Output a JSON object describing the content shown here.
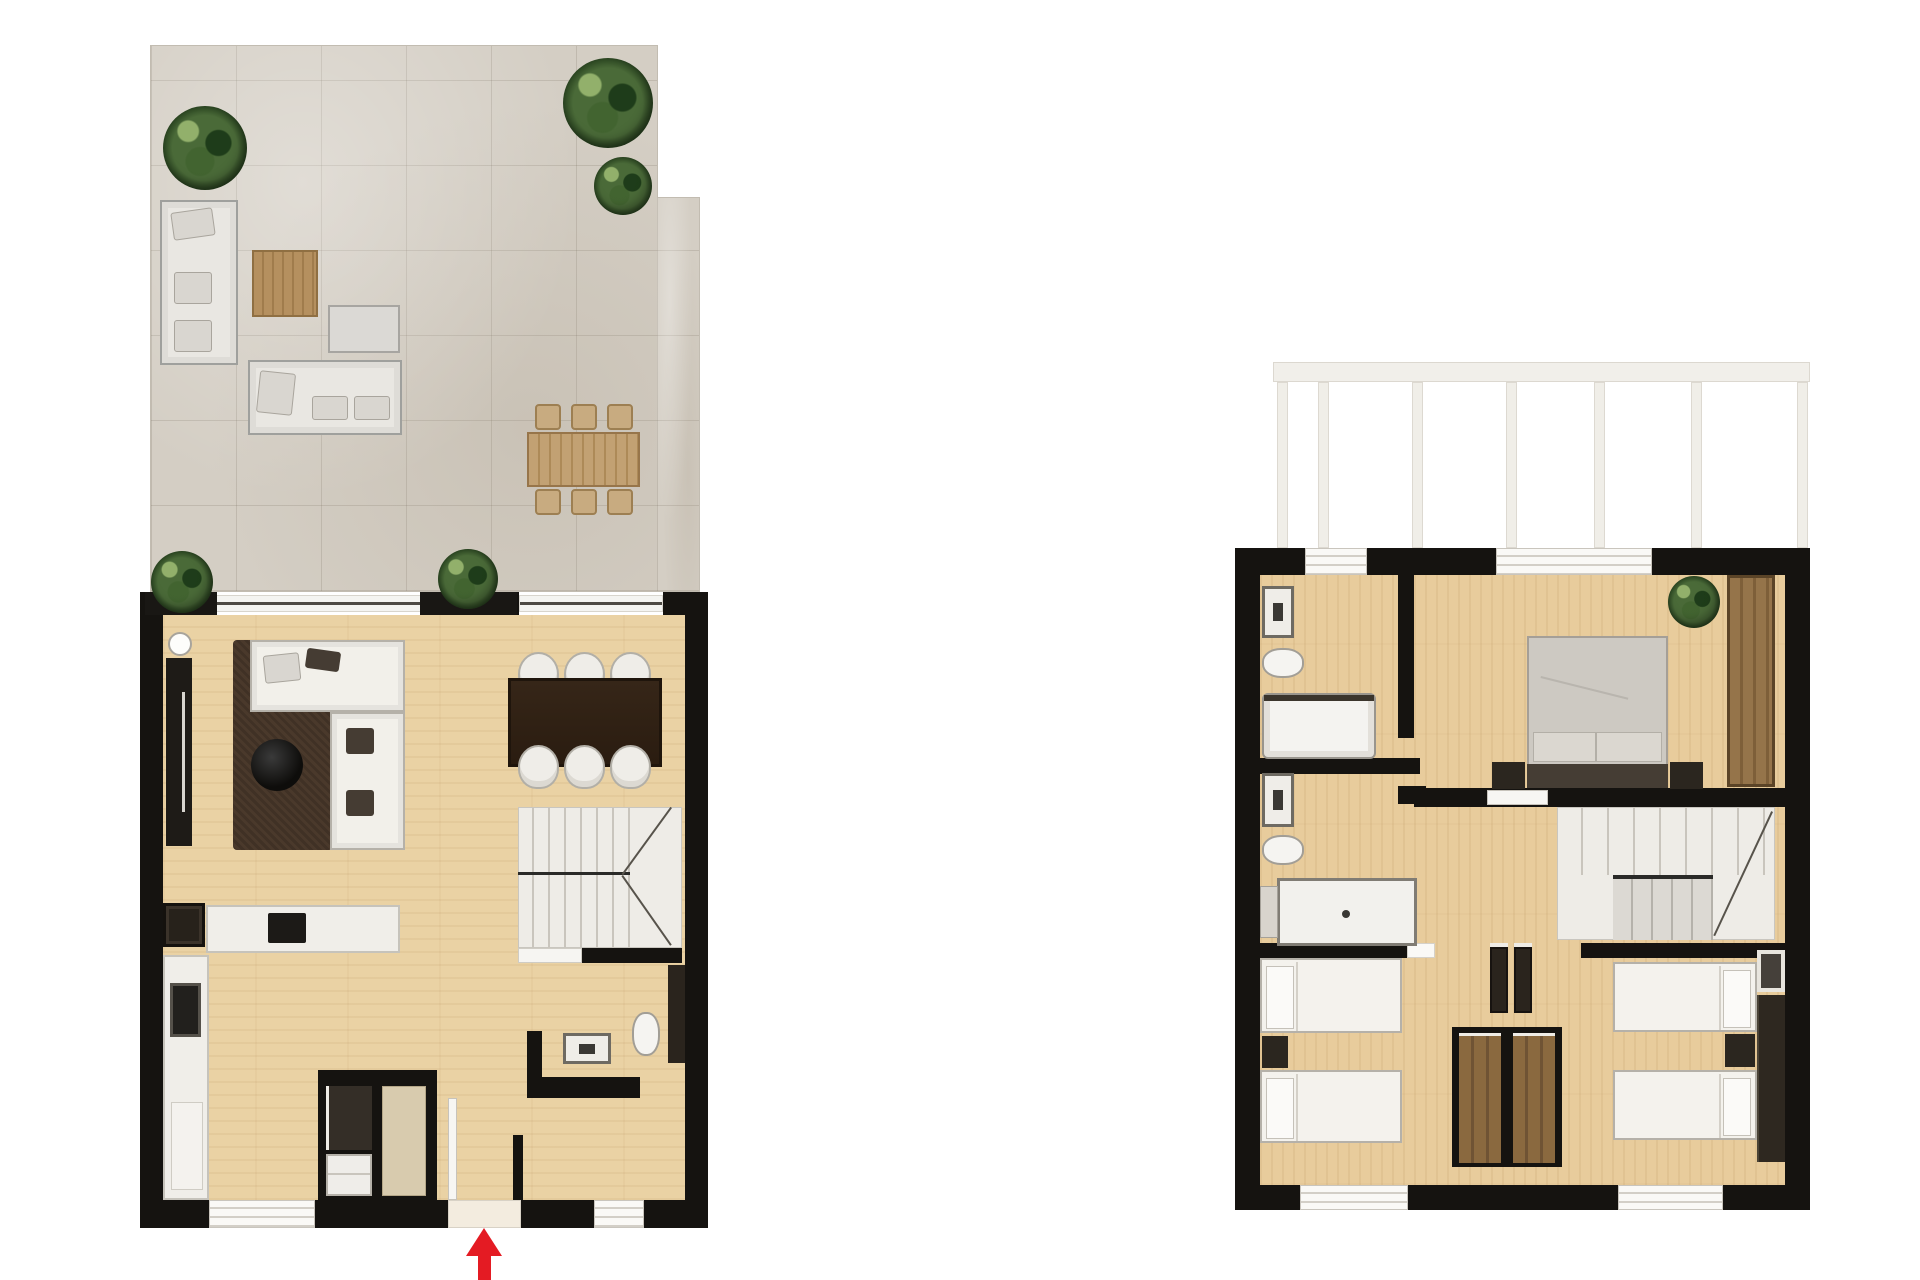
{
  "document": {
    "type": "architectural floor plan rendering",
    "description": "Two top-down rendered floor plans of a duplex home shown side by side on a white background, no text labels",
    "floors": [
      {
        "name": "ground-floor-with-terrace",
        "position": "left"
      },
      {
        "name": "first-floor",
        "position": "right"
      }
    ]
  },
  "colors": {
    "wall": "#151310",
    "floor_ground": "#ead2a4",
    "floor_first": "#e8cc9c",
    "terrace": "#d4cec4",
    "rug": "#4a392b",
    "sofa_white": "#f2f0ea",
    "furn_border": "#b5b1a9",
    "gray_outdoor": "#e9e7e2",
    "wood_table": "#ad8a58",
    "wood_chair": "#c8ab80",
    "dining_dark": "#2f2115",
    "stairs_light": "#eeece7",
    "stairs_mid": "#dcd9d3",
    "wardrobe": "#8a693f",
    "dark_panel": "#2a241d",
    "white_fix": "#f5f4f1",
    "red": "#e41b23",
    "rail": "#f1efea",
    "duvet": "#cdc9c2",
    "headboard": "#453d34"
  },
  "ground_floor": {
    "terrace": {
      "surface": "stone tiles",
      "items": [
        "potted-plant",
        "potted-plant",
        "potted-plant",
        "outdoor-corner-sofa",
        "outdoor-sofa",
        "wood-coffee-table",
        "side-table-ottoman",
        "outdoor-dining-table",
        "six-outdoor-chairs",
        "planter-box",
        "planter-box"
      ]
    },
    "interior": {
      "rooms": [
        "living-room",
        "dining-area",
        "kitchen",
        "bathroom",
        "storage-closet",
        "staircase",
        "entrance-hall"
      ],
      "items": [
        "l-shaped-sofa",
        "dark-brown-rug",
        "round-coffee-table",
        "tv-unit",
        "floor-lamp",
        "dining-table-6-chairs",
        "staircase-up",
        "kitchen-island-with-cooktop",
        "oven-column",
        "kitchen-counter-with-sink",
        "laundry-closet",
        "washbasin-vanity",
        "toilet",
        "entrance-door",
        "windows",
        "sliding-glass-doors"
      ]
    },
    "entrance_arrow": {
      "direction": "up",
      "color": "#e41b23"
    }
  },
  "first_floor": {
    "balcony": {
      "items": [
        "railing-top-bar",
        "railing-posts"
      ]
    },
    "interior": {
      "rooms": [
        "bathroom-top",
        "bathroom-middle",
        "master-bedroom",
        "twin-bedroom-left",
        "twin-bedroom-right",
        "hall",
        "staircase"
      ],
      "items": [
        "washbasin-vanity",
        "toilet",
        "bathtub",
        "washbasin-vanity",
        "toilet",
        "shower-tray",
        "double-bed",
        "nightstand",
        "nightstand",
        "potted-plant",
        "built-in-wardrobe",
        "staircase-down",
        "double-wardrobe-block",
        "door-panel",
        "door-panel",
        "single-bed",
        "single-bed",
        "nightstand",
        "single-bed",
        "single-bed",
        "nightstand",
        "wardrobe-strip",
        "framed-dresser",
        "windows"
      ]
    }
  }
}
